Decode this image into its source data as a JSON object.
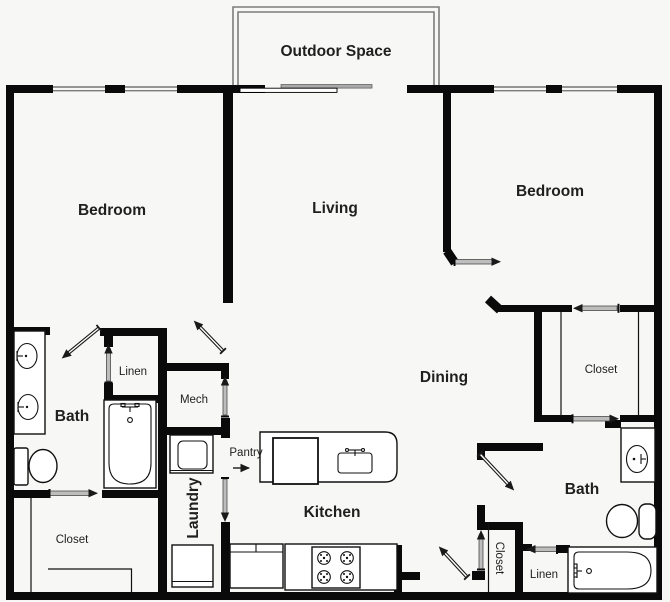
{
  "plan": {
    "outdoor_space": "Outdoor Space",
    "bedroom_left": "Bedroom",
    "living": "Living",
    "bedroom_right": "Bedroom",
    "dining": "Dining",
    "bath_left": "Bath",
    "bath_right": "Bath",
    "kitchen": "Kitchen",
    "laundry": "Laundry",
    "pantry": "Pantry",
    "mech": "Mech",
    "linen_left": "Linen",
    "linen_bottom": "Linen",
    "closet_left": "Closet",
    "closet_right": "Closet",
    "closet_bottom": "Closet"
  },
  "colors": {
    "background": "#f7f7f5",
    "wall": "#0a0a0a",
    "label": "#1f1f1f",
    "slider": "#bdbdbd",
    "slider_border": "#4a4a4a",
    "balcony": "#7d7d7d",
    "fixture": "#111111"
  }
}
